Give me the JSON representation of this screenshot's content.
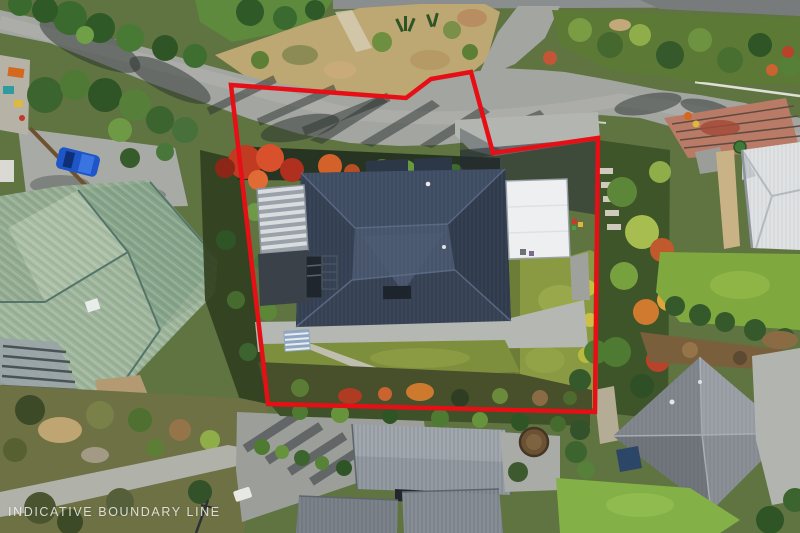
{
  "image": {
    "type": "aerial-drone-photo",
    "subject": "residential section with indicative boundary overlay"
  },
  "overlay": {
    "caption": "INDICATIVE BOUNDARY LINE",
    "caption_color": "rgba(255,255,255,0.78)",
    "boundary": {
      "color": "#e60f16",
      "stroke_width": "4.5",
      "points": "231,85 406,98 431,79 471,72 493,153 598,138 595,412 268,404"
    }
  },
  "scene": {
    "road": {
      "name": "street",
      "color": "#a3a5a1"
    },
    "subject_house": {
      "roof_color": "#354153",
      "garage_roof_color": "#edeff0",
      "lawn_color": "#8a9a42"
    },
    "left_house": {
      "roof_color": "#93ab90"
    },
    "right_house": {
      "roof_color": "#dfe2e4"
    },
    "top_right_deck": {
      "color": "#b97b66"
    },
    "bottom_house": {
      "roof_color": "#939aa1"
    },
    "bottom_right_house": {
      "roof_color": "#868c92"
    },
    "vehicles": {
      "blue_car": "#1e55c8",
      "white_car": "#e8e8e4"
    }
  }
}
